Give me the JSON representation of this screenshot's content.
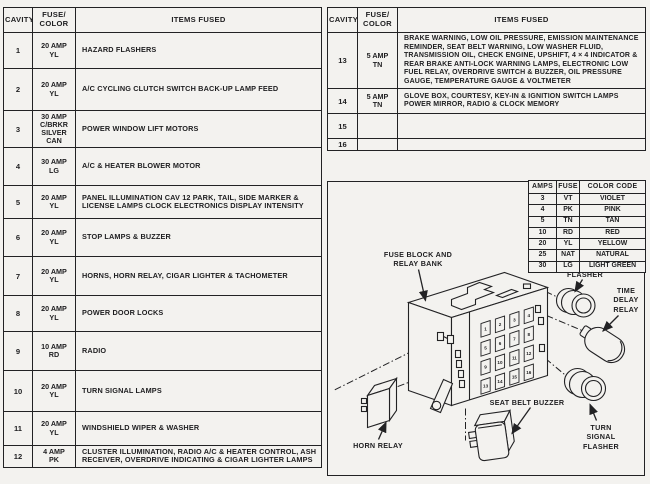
{
  "colors": {
    "ink": "#222224",
    "paper": "#f3f2ef"
  },
  "left_table": {
    "headers": {
      "cavity": "CAVITY",
      "fuse": "FUSE/\nCOLOR",
      "items": "ITEMS FUSED"
    },
    "rows": [
      {
        "cavity": "1",
        "fuse": "20 AMP\nYL",
        "items": "HAZARD FLASHERS"
      },
      {
        "cavity": "2",
        "fuse": "20 AMP\nYL",
        "items": "A/C CYCLING CLUTCH SWITCH BACK-UP LAMP FEED"
      },
      {
        "cavity": "3",
        "fuse": "30 AMP\nC/BRKR\nSILVER\nCAN",
        "items": "POWER WINDOW LIFT MOTORS"
      },
      {
        "cavity": "4",
        "fuse": "30 AMP\nLG",
        "items": "A/C & HEATER BLOWER MOTOR"
      },
      {
        "cavity": "5",
        "fuse": "20 AMP\nYL",
        "items": "PANEL ILLUMINATION CAV 12 PARK, TAIL, SIDE MARKER & LICENSE LAMPS CLOCK ELECTRONICS DISPLAY INTENSITY"
      },
      {
        "cavity": "6",
        "fuse": "20 AMP\nYL",
        "items": "STOP LAMPS & BUZZER"
      },
      {
        "cavity": "7",
        "fuse": "20 AMP\nYL",
        "items": "HORNS, HORN RELAY, CIGAR LIGHTER & TACHOMETER"
      },
      {
        "cavity": "8",
        "fuse": "20 AMP\nYL",
        "items": "POWER DOOR LOCKS"
      },
      {
        "cavity": "9",
        "fuse": "10 AMP\nRD",
        "items": "RADIO"
      },
      {
        "cavity": "10",
        "fuse": "20 AMP\nYL",
        "items": "TURN SIGNAL LAMPS"
      },
      {
        "cavity": "11",
        "fuse": "20 AMP\nYL",
        "items": "WINDSHIELD WIPER & WASHER"
      },
      {
        "cavity": "12",
        "fuse": "4 AMP\nPK",
        "items": "CLUSTER ILLUMINATION, RADIO A/C & HEATER CONTROL, ASH RECEIVER, OVERDRIVE INDICATING & CIGAR LIGHTER LAMPS"
      }
    ]
  },
  "right_table": {
    "headers": {
      "cavity": "CAVITY",
      "fuse": "FUSE/\nCOLOR",
      "items": "ITEMS FUSED"
    },
    "rows": [
      {
        "cavity": "13",
        "fuse": "5 AMP\nTN",
        "items": "BRAKE WARNING, LOW OIL PRESSURE, EMISSION MAINTENANCE REMINDER, SEAT BELT WARNING, LOW WASHER FLUID, TRANSMISSION OIL, CHECK ENGINE, UPSHIFT, 4 × 4 INDICATOR & REAR BRAKE ANTI-LOCK WARNING LAMPS, ELECTRONIC LOW FUEL RELAY, OVERDRIVE SWITCH & BUZZER, OIL PRESSURE GAUGE, TEMPERATURE GAUGE & VOLTMETER"
      },
      {
        "cavity": "14",
        "fuse": "5 AMP\nTN",
        "items": "GLOVE BOX, COURTESY, KEY-IN & IGNITION SWITCH LAMPS POWER MIRROR, RADIO & CLOCK MEMORY"
      },
      {
        "cavity": "15",
        "fuse": "",
        "items": ""
      },
      {
        "cavity": "16",
        "fuse": "",
        "items": ""
      }
    ]
  },
  "color_code_table": {
    "headers": {
      "amps": "AMPS",
      "fuse": "FUSE",
      "color": "COLOR CODE"
    },
    "rows": [
      {
        "amps": "3",
        "fuse": "VT",
        "color": "VIOLET"
      },
      {
        "amps": "4",
        "fuse": "PK",
        "color": "PINK"
      },
      {
        "amps": "5",
        "fuse": "TN",
        "color": "TAN"
      },
      {
        "amps": "10",
        "fuse": "RD",
        "color": "RED"
      },
      {
        "amps": "20",
        "fuse": "YL",
        "color": "YELLOW"
      },
      {
        "amps": "25",
        "fuse": "NAT",
        "color": "NATURAL"
      },
      {
        "amps": "30",
        "fuse": "LG",
        "color": "LIGHT GREEN"
      }
    ]
  },
  "diagram": {
    "labels": {
      "fuse_block": "FUSE BLOCK AND\nRELAY BANK",
      "hazard_flasher": "HAZARD\nFLASHER",
      "time_delay_relay": "TIME\nDELAY\nRELAY",
      "seat_belt_buzzer": "SEAT BELT BUZZER",
      "turn_signal_flasher": "TURN\nSIGNAL\nFLASHER",
      "horn_relay": "HORN RELAY"
    },
    "fuse_block": {
      "slots": [
        "1",
        "2",
        "3",
        "4",
        "5",
        "6",
        "7",
        "8",
        "9",
        "10",
        "11",
        "12",
        "13",
        "14",
        "15",
        "16"
      ]
    }
  }
}
